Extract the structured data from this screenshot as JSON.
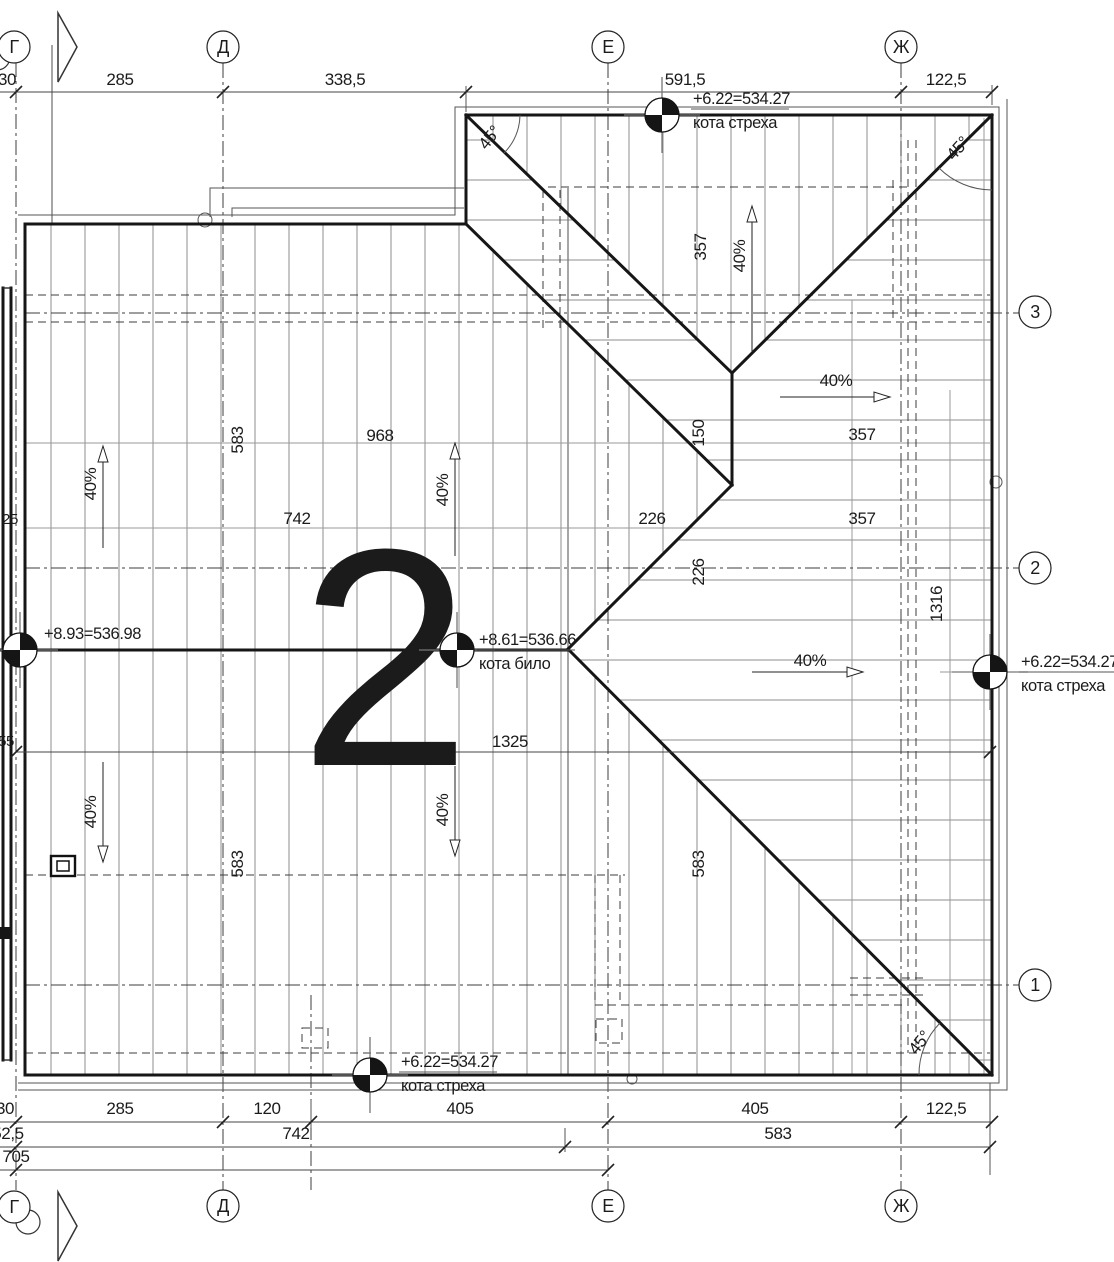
{
  "title": "Roof plan sheet",
  "watermark": {
    "text": "2",
    "color": "#9c9c9c"
  },
  "colors": {
    "line": "#161616",
    "hatch": "#8d8d8d",
    "dashed": "#3c3c3c",
    "watermark": "#9c9c9c"
  },
  "grid_bubbles": {
    "top": [
      {
        "l": "Г",
        "x": 14,
        "y": 47
      },
      {
        "l": "Д",
        "x": 223,
        "y": 47
      },
      {
        "l": "Е",
        "x": 608,
        "y": 47
      },
      {
        "l": "Ж",
        "x": 901,
        "y": 47
      }
    ],
    "bottom": [
      {
        "l": "Г",
        "x": 14,
        "y": 1207
      },
      {
        "l": "Д",
        "x": 223,
        "y": 1206
      },
      {
        "l": "Е",
        "x": 608,
        "y": 1206
      },
      {
        "l": "Ж",
        "x": 901,
        "y": 1206
      }
    ],
    "right": [
      {
        "l": "3",
        "x": 1035,
        "y": 312
      },
      {
        "l": "2",
        "x": 1035,
        "y": 568
      },
      {
        "l": "1",
        "x": 1035,
        "y": 985
      }
    ]
  },
  "dim_rows": [
    {
      "y": 85,
      "items": [
        {
          "t": "30",
          "x": 7
        },
        {
          "t": "285",
          "x": 120
        },
        {
          "t": "338,5",
          "x": 345
        },
        {
          "t": "591,5",
          "x": 685
        },
        {
          "t": "122,5",
          "x": 946
        }
      ]
    },
    {
      "y": 1114,
      "items": [
        {
          "t": "30",
          "x": 5
        },
        {
          "t": "285",
          "x": 120
        },
        {
          "t": "120",
          "x": 267
        },
        {
          "t": "405",
          "x": 460
        },
        {
          "t": "405",
          "x": 755
        },
        {
          "t": "122,5",
          "x": 946
        }
      ]
    },
    {
      "y": 1139,
      "items": [
        {
          "t": "52,5",
          "x": 8
        },
        {
          "t": "742",
          "x": 296
        },
        {
          "t": "583",
          "x": 778
        }
      ]
    },
    {
      "y": 1162,
      "items": [
        {
          "t": "705",
          "x": 16
        }
      ]
    }
  ],
  "labels": [
    {
      "t": "583",
      "x": 243,
      "y": 440,
      "rot": -90
    },
    {
      "t": "968",
      "x": 380,
      "y": 441
    },
    {
      "t": "742",
      "x": 297,
      "y": 524
    },
    {
      "t": "357",
      "x": 706,
      "y": 247,
      "rot": -90
    },
    {
      "t": "150",
      "x": 704,
      "y": 433,
      "rot": -90
    },
    {
      "t": "226",
      "x": 652,
      "y": 524
    },
    {
      "t": "226",
      "x": 704,
      "y": 572,
      "rot": -90
    },
    {
      "t": "357",
      "x": 862,
      "y": 440
    },
    {
      "t": "357",
      "x": 862,
      "y": 524
    },
    {
      "t": "1316",
      "x": 942,
      "y": 604,
      "rot": -90
    },
    {
      "t": "1325",
      "x": 510,
      "y": 747
    },
    {
      "t": "583",
      "x": 243,
      "y": 864,
      "rot": -90
    },
    {
      "t": "583",
      "x": 704,
      "y": 864,
      "rot": -90
    },
    {
      "t": "25",
      "x": 10,
      "y": 524,
      "size": 15
    },
    {
      "t": "55",
      "x": 6,
      "y": 746,
      "size": 15
    },
    {
      "t": "40%",
      "x": 96,
      "y": 484,
      "rot": -90,
      "name": "slope-label"
    },
    {
      "t": "40%",
      "x": 448,
      "y": 490,
      "rot": -90,
      "name": "slope-label"
    },
    {
      "t": "40%",
      "x": 745,
      "y": 256,
      "rot": -90,
      "name": "slope-label"
    },
    {
      "t": "40%",
      "x": 836,
      "y": 386,
      "name": "slope-label"
    },
    {
      "t": "40%",
      "x": 810,
      "y": 666,
      "name": "slope-label"
    },
    {
      "t": "40%",
      "x": 96,
      "y": 812,
      "rot": -90,
      "name": "slope-label"
    },
    {
      "t": "40%",
      "x": 448,
      "y": 810,
      "rot": -90,
      "name": "slope-label"
    },
    {
      "t": "45°",
      "x": 494,
      "y": 141,
      "rot": -52,
      "name": "angle-label"
    },
    {
      "t": "45°",
      "x": 962,
      "y": 152,
      "rot": -48,
      "name": "angle-label"
    },
    {
      "t": "45°",
      "x": 924,
      "y": 1046,
      "rot": -52,
      "name": "angle-label"
    }
  ],
  "elevation_markers": [
    {
      "x": 662,
      "y": 115,
      "tx": 693,
      "ty": 104,
      "lines": [
        "+6.22=534.27",
        "кота стреха"
      ]
    },
    {
      "x": 20,
      "y": 650,
      "tx": 44,
      "ty": 639,
      "lines": [
        "+8.93=536.98"
      ]
    },
    {
      "x": 457,
      "y": 650,
      "tx": 479,
      "ty": 645,
      "lines": [
        "+8.61=536.66",
        "кота било"
      ]
    },
    {
      "x": 990,
      "y": 672,
      "tx": 1021,
      "ty": 667,
      "lines": [
        "+6.22=534.27",
        "кота стреха"
      ]
    },
    {
      "x": 370,
      "y": 1075,
      "tx": 401,
      "ty": 1067,
      "lines": [
        "+6.22=534.27",
        "кота стреха"
      ]
    }
  ]
}
